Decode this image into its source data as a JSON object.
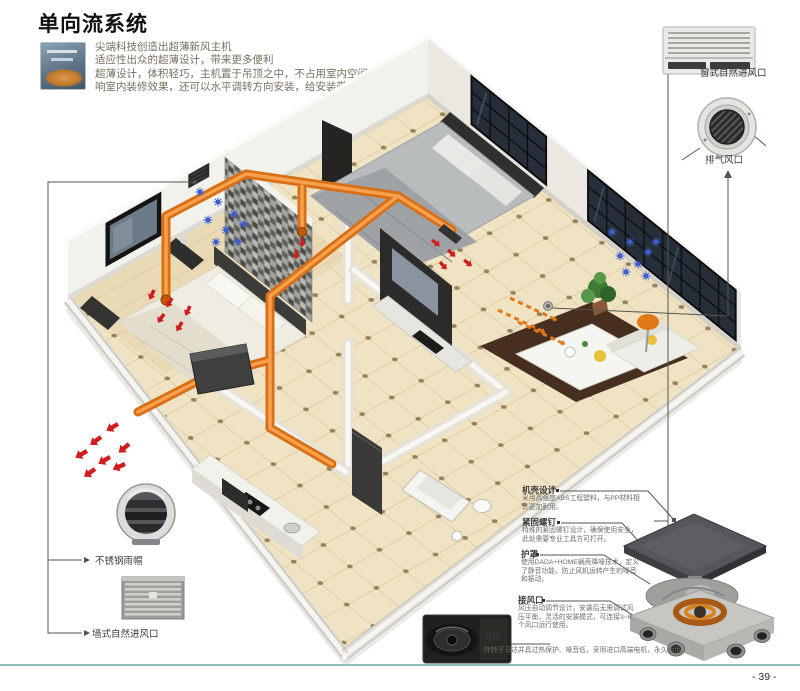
{
  "page": {
    "title": "单向流系统",
    "page_number": "- 39 -"
  },
  "intro": {
    "lines": [
      "尖端科技创造出超薄新风主机",
      "适应性出众的超薄设计，带来更多便利",
      "超薄设计，体积轻巧，主机置于吊顶之中，不占用室内空间，不影",
      "响室内装修效果，还可以水平调转方向安装，给安装带来极大便利。"
    ]
  },
  "callouts": {
    "window_inlet": {
      "label": "窗式自然进风口"
    },
    "exhaust_outlet": {
      "label": "排气风口"
    },
    "rain_cap": {
      "label": "不锈钢雨帽"
    },
    "wall_inlet": {
      "label": "墙式自然进风口"
    }
  },
  "features": [
    {
      "title": "机壳设计",
      "desc": "采用高强度ABS工程塑料，与PP材料相比更加耐用。"
    },
    {
      "title": "紧固螺钉",
      "desc": "特殊的紧固螺钉设计，确保使用安全，此处需要专业工具方可打开。"
    },
    {
      "title": "护罩",
      "desc": "使用DADA+HOME蜗壳降噪技术，定义了静音功能，防止风机运转产生的噪音和振动。"
    },
    {
      "title": "接风口",
      "desc": "风压自动调节设计，安装后无需调试风压平衡，灵活的安装模式，可连接3~6个风口运行使用。"
    }
  ],
  "motor": {
    "title": "马达",
    "desc": "外转子马达并具过热保护、噪音低，采用进口高端电机，永久耐用。"
  },
  "colors": {
    "duct_orange": "#e2761b",
    "arrow_red": "#cf1d1d",
    "arrow_blue": "#3f5fd0",
    "rule_teal": "#8dbfb8"
  }
}
